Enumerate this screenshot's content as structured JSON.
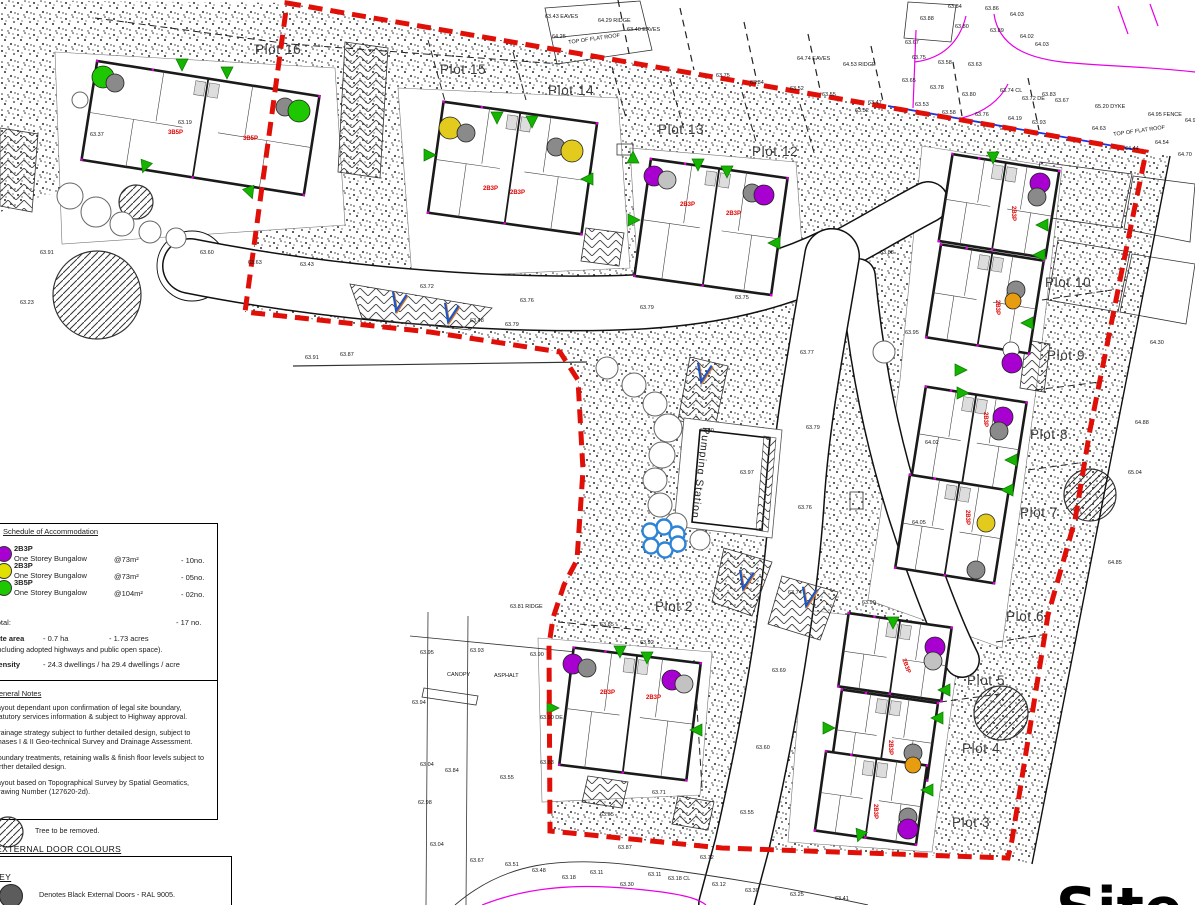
{
  "title_partial": "Site plan",
  "pumping_station": "Pumping Station",
  "colors": {
    "boundary_red": "#e01008",
    "legal_blue": "#2233dd",
    "survey_magenta": "#e800e8",
    "marker_purple": "#a800d0",
    "marker_yellow": "#e2cb1d",
    "marker_orange": "#e89c10",
    "marker_green": "#1ec800",
    "marker_gray": "#8a8a8a",
    "marker_lgray": "#c2c2c2",
    "marker_white": "#ffffff",
    "attenuation_blue": "#2d83d5",
    "unit_label_red": "#e00000"
  },
  "legend": {
    "schedule": {
      "heading": "Schedule of Accommodation",
      "items": [
        {
          "color": "#a800d0",
          "code": "2B3P",
          "desc": "One Storey Bungalow",
          "area": "@73m²",
          "count": "- 10no."
        },
        {
          "color": "#e2e000",
          "code": "2B3P",
          "desc": "One Storey Bungalow",
          "area": "@73m²",
          "count": "- 05no."
        },
        {
          "color": "#1ec800",
          "code": "3B5P",
          "desc": "One Storey Bungalow",
          "area": "@104m²",
          "count": "- 02no."
        }
      ],
      "total_label": "Total:",
      "total_value": "- 17 no.",
      "site_area_label": "Site area",
      "site_area_ha": "- 0.7 ha",
      "site_area_acres": "- 1.73 acres",
      "site_area_note": "(Including adopted highways and public open space).",
      "density_label": "Density",
      "density_ha": "- 24.3 dwellings / ha",
      "density_acre": "- 29.4 dwellings / acre"
    },
    "general_notes": {
      "heading": "General Notes",
      "notes": [
        "Layout dependant upon confirmation of legal site boundary, statutory services information & subject to Highway approval.",
        "Drainage strategy subject to further detailed design, subject to Phases I & II Geo-technical Survey and Drainage Assessment.",
        "Boundary treatments, retaining walls & finish floor levels subject to further detailed design.",
        "Layout based on Topographical Survey by Spatial Geomatics, Drawing Number (127620-2d)."
      ]
    },
    "tree_key": "Tree to be removed.",
    "door_colours_heading": "EXTERNAL DOOR COLOURS",
    "key_heading": "KEY",
    "key_item": "Denotes Black External Doors - RAL 9005."
  },
  "plots": [
    [
      255,
      42,
      "Plot 16"
    ],
    [
      440,
      62,
      "Plot 15"
    ],
    [
      548,
      83,
      "Plot 14"
    ],
    [
      658,
      122,
      "Plot 13"
    ],
    [
      752,
      144,
      "Plot 12"
    ],
    [
      1045,
      275,
      "Plot 10"
    ],
    [
      1047,
      348,
      "Plot 9"
    ],
    [
      1030,
      427,
      "Plot 8"
    ],
    [
      1020,
      505,
      "Plot 7"
    ],
    [
      1006,
      609,
      "Plot 6"
    ],
    [
      967,
      673,
      "Plot 5"
    ],
    [
      962,
      741,
      "Plot 4"
    ],
    [
      952,
      815,
      "Plot 3"
    ],
    [
      655,
      599,
      "Plot 2"
    ]
  ],
  "buildings": [
    [
      88,
      78,
      225,
      100,
      9
    ],
    [
      435,
      112,
      155,
      112,
      8
    ],
    [
      642,
      168,
      138,
      118,
      8
    ],
    [
      945,
      162,
      108,
      88,
      9
    ],
    [
      933,
      252,
      104,
      94,
      9
    ],
    [
      918,
      394,
      102,
      92,
      9
    ],
    [
      902,
      482,
      100,
      94,
      9
    ],
    [
      566,
      655,
      128,
      118,
      7
    ],
    [
      843,
      620,
      104,
      74,
      8
    ],
    [
      836,
      696,
      97,
      78,
      8
    ],
    [
      820,
      758,
      102,
      80,
      8
    ]
  ],
  "markers": [
    [
      103,
      77,
      11,
      "green"
    ],
    [
      115,
      83,
      9,
      "gray"
    ],
    [
      285,
      107,
      9,
      "gray"
    ],
    [
      299,
      111,
      11,
      "green"
    ],
    [
      450,
      128,
      11,
      "yellow"
    ],
    [
      466,
      133,
      9,
      "gray"
    ],
    [
      556,
      147,
      9,
      "gray"
    ],
    [
      572,
      151,
      11,
      "yellow"
    ],
    [
      654,
      176,
      10,
      "purple"
    ],
    [
      667,
      180,
      9,
      "lgray"
    ],
    [
      752,
      193,
      9,
      "gray"
    ],
    [
      764,
      195,
      10,
      "purple"
    ],
    [
      1040,
      183,
      10,
      "purple"
    ],
    [
      1037,
      197,
      9,
      "gray"
    ],
    [
      1016,
      290,
      9,
      "gray"
    ],
    [
      1013,
      301,
      8,
      "orange"
    ],
    [
      1011,
      350,
      8,
      "white"
    ],
    [
      1012,
      363,
      10,
      "purple"
    ],
    [
      1003,
      417,
      10,
      "purple"
    ],
    [
      999,
      431,
      9,
      "gray"
    ],
    [
      986,
      523,
      9,
      "yellow"
    ],
    [
      976,
      570,
      9,
      "gray"
    ],
    [
      573,
      664,
      10,
      "purple"
    ],
    [
      587,
      668,
      9,
      "gray"
    ],
    [
      672,
      680,
      10,
      "purple"
    ],
    [
      684,
      684,
      9,
      "lgray"
    ],
    [
      935,
      647,
      10,
      "purple"
    ],
    [
      933,
      661,
      9,
      "lgray"
    ],
    [
      913,
      753,
      9,
      "gray"
    ],
    [
      913,
      765,
      8,
      "orange"
    ],
    [
      908,
      817,
      9,
      "gray"
    ],
    [
      908,
      829,
      10,
      "purple"
    ]
  ],
  "triangles": [
    [
      182,
      64,
      180
    ],
    [
      227,
      72,
      180
    ],
    [
      145,
      166,
      200
    ],
    [
      250,
      192,
      160
    ],
    [
      497,
      117,
      180
    ],
    [
      532,
      121,
      180
    ],
    [
      429,
      155,
      90
    ],
    [
      588,
      179,
      270
    ],
    [
      698,
      164,
      180
    ],
    [
      727,
      171,
      180
    ],
    [
      633,
      220,
      90
    ],
    [
      775,
      243,
      270
    ],
    [
      993,
      157,
      180
    ],
    [
      1043,
      225,
      270
    ],
    [
      1040,
      255,
      270
    ],
    [
      1028,
      323,
      270
    ],
    [
      960,
      370,
      90
    ],
    [
      962,
      393,
      90
    ],
    [
      1012,
      460,
      270
    ],
    [
      1008,
      490,
      270
    ],
    [
      620,
      651,
      180
    ],
    [
      647,
      657,
      180
    ],
    [
      552,
      708,
      90
    ],
    [
      697,
      730,
      270
    ],
    [
      893,
      622,
      180
    ],
    [
      945,
      690,
      270
    ],
    [
      938,
      718,
      270
    ],
    [
      828,
      728,
      90
    ],
    [
      928,
      790,
      270
    ],
    [
      860,
      835,
      200
    ],
    [
      633,
      158,
      0
    ]
  ],
  "trees_removed": [
    [
      97,
      295,
      44
    ],
    [
      136,
      202,
      17
    ],
    [
      1090,
      495,
      26
    ],
    [
      1001,
      713,
      27
    ]
  ],
  "trees_plain": [
    [
      80,
      100,
      8
    ],
    [
      70,
      196,
      13
    ],
    [
      96,
      212,
      15
    ],
    [
      122,
      224,
      12
    ],
    [
      150,
      232,
      11
    ],
    [
      176,
      238,
      10
    ],
    [
      607,
      368,
      11
    ],
    [
      634,
      385,
      12
    ],
    [
      655,
      404,
      12
    ],
    [
      668,
      428,
      14
    ],
    [
      662,
      455,
      13
    ],
    [
      655,
      480,
      12
    ],
    [
      660,
      505,
      12
    ],
    [
      676,
      524,
      11
    ],
    [
      700,
      540,
      10
    ],
    [
      884,
      352,
      11
    ]
  ],
  "v_marks": [
    [
      398,
      302
    ],
    [
      450,
      313
    ],
    [
      703,
      373
    ],
    [
      745,
      580
    ],
    [
      808,
      597
    ]
  ],
  "attenuation_circles": [
    [
      650,
      531
    ],
    [
      664,
      527
    ],
    [
      677,
      534
    ],
    [
      651,
      546
    ],
    [
      665,
      550
    ],
    [
      678,
      544
    ]
  ],
  "unit_labels": [
    [
      "3B5P",
      168,
      130,
      0
    ],
    [
      "3B5P",
      243,
      136,
      0
    ],
    [
      "2B3P",
      483,
      186,
      0
    ],
    [
      "2B3P",
      510,
      190,
      0
    ],
    [
      "2B3P",
      680,
      202,
      0
    ],
    [
      "2B3P",
      726,
      211,
      0
    ],
    [
      "2B3P",
      600,
      690,
      0
    ],
    [
      "2B3P",
      646,
      695,
      0
    ],
    [
      "2B3P",
      1016,
      206,
      90
    ],
    [
      "2B3P",
      1000,
      300,
      90
    ],
    [
      "2B3P",
      988,
      412,
      90
    ],
    [
      "2B3P",
      970,
      510,
      90
    ],
    [
      "2B3P",
      906,
      658,
      70
    ],
    [
      "2B3P",
      893,
      740,
      90
    ],
    [
      "2B3P",
      878,
      804,
      90
    ]
  ],
  "spot_levels": [
    [
      948,
      4,
      "63.84"
    ],
    [
      985,
      6,
      "63.86"
    ],
    [
      1010,
      12,
      "64.03"
    ],
    [
      920,
      16,
      "63.88"
    ],
    [
      955,
      24,
      "63.80"
    ],
    [
      990,
      28,
      "63.89"
    ],
    [
      1020,
      34,
      "64.02"
    ],
    [
      1035,
      42,
      "64.03"
    ],
    [
      905,
      40,
      "63.67"
    ],
    [
      912,
      55,
      "63.75"
    ],
    [
      938,
      60,
      "63.58"
    ],
    [
      968,
      62,
      "63.63"
    ],
    [
      902,
      78,
      "63.65"
    ],
    [
      930,
      85,
      "63.78"
    ],
    [
      962,
      92,
      "63.80"
    ],
    [
      1000,
      88,
      "63.74 CL"
    ],
    [
      1022,
      96,
      "63.72 DE"
    ],
    [
      1042,
      92,
      "63.83"
    ],
    [
      1055,
      98,
      "63.67"
    ],
    [
      915,
      102,
      "63.53"
    ],
    [
      942,
      110,
      "63.58"
    ],
    [
      975,
      112,
      "63.76"
    ],
    [
      1008,
      116,
      "64.19"
    ],
    [
      1032,
      120,
      "63.93"
    ],
    [
      545,
      14,
      "63.43 EAVES"
    ],
    [
      598,
      18,
      "64.29 RIDGE"
    ],
    [
      552,
      34,
      "64.25"
    ],
    [
      627,
      27,
      "63.40 EAVES"
    ],
    [
      797,
      56,
      "64.74 EAVES"
    ],
    [
      843,
      62,
      "64.53 RIDGE"
    ],
    [
      868,
      100,
      "63.47"
    ],
    [
      716,
      73,
      "63.75"
    ],
    [
      750,
      80,
      "63.84"
    ],
    [
      790,
      86,
      "63.52"
    ],
    [
      822,
      92,
      "63.55"
    ],
    [
      855,
      108,
      "63.52"
    ],
    [
      568,
      40,
      "TOP OF FLAT ROOF",
      -8
    ],
    [
      1113,
      132,
      "TOP OF FLAT ROOF",
      -8
    ],
    [
      1095,
      104,
      "65.20 DYKE"
    ],
    [
      1148,
      112,
      "64.95 FENCE"
    ],
    [
      1185,
      118,
      "64.99 DYKE"
    ],
    [
      1092,
      126,
      "64.63"
    ],
    [
      1125,
      146,
      "64.44"
    ],
    [
      1155,
      140,
      "64.54"
    ],
    [
      1178,
      152,
      "64.70"
    ],
    [
      305,
      355,
      "63.91"
    ],
    [
      340,
      352,
      "63.87"
    ],
    [
      510,
      604,
      "63.81 RIDGE"
    ],
    [
      447,
      672,
      "CANOPY"
    ],
    [
      494,
      673,
      "ASPHALT"
    ],
    [
      420,
      650,
      "63.95"
    ],
    [
      470,
      648,
      "63.93"
    ],
    [
      530,
      652,
      "63.90"
    ],
    [
      412,
      700,
      "63.94"
    ],
    [
      540,
      715,
      "63.90 DE"
    ],
    [
      420,
      762,
      "63.04"
    ],
    [
      445,
      768,
      "63.84"
    ],
    [
      500,
      775,
      "63.55"
    ],
    [
      540,
      760,
      "63.83"
    ],
    [
      418,
      800,
      "62.98"
    ],
    [
      430,
      842,
      "63.04"
    ],
    [
      470,
      858,
      "63.67"
    ],
    [
      505,
      862,
      "63.51"
    ],
    [
      532,
      868,
      "63.48"
    ],
    [
      562,
      875,
      "63.18"
    ],
    [
      590,
      870,
      "63.11"
    ],
    [
      620,
      882,
      "63.30"
    ],
    [
      648,
      872,
      "63.11"
    ],
    [
      668,
      876,
      "63.18 CL"
    ],
    [
      712,
      882,
      "63.12"
    ],
    [
      745,
      888,
      "63.30"
    ],
    [
      790,
      892,
      "63.25"
    ],
    [
      835,
      896,
      "63.41"
    ],
    [
      618,
      845,
      "63.87"
    ],
    [
      700,
      855,
      "63.72"
    ],
    [
      1150,
      340,
      "64.30"
    ],
    [
      1135,
      420,
      "64.88"
    ],
    [
      1128,
      470,
      "65.04"
    ],
    [
      1108,
      560,
      "64.85"
    ],
    [
      300,
      262,
      "63.43"
    ],
    [
      420,
      284,
      "63.72"
    ],
    [
      520,
      298,
      "63.76"
    ],
    [
      640,
      305,
      "63.79"
    ],
    [
      735,
      295,
      "63.75"
    ],
    [
      800,
      350,
      "63.77"
    ],
    [
      806,
      425,
      "63.79"
    ],
    [
      798,
      505,
      "63.76"
    ],
    [
      470,
      318,
      "63.48"
    ],
    [
      505,
      322,
      "63.79"
    ],
    [
      740,
      470,
      "63.97"
    ],
    [
      700,
      428,
      "63.80"
    ],
    [
      788,
      590,
      "63.74"
    ],
    [
      772,
      668,
      "63.69"
    ],
    [
      756,
      745,
      "63.60"
    ],
    [
      740,
      810,
      "63.55"
    ],
    [
      652,
      790,
      "63.71"
    ],
    [
      600,
      812,
      "63.65"
    ],
    [
      880,
      250,
      "63.88"
    ],
    [
      905,
      330,
      "63.95"
    ],
    [
      925,
      440,
      "64.02"
    ],
    [
      912,
      520,
      "64.05"
    ],
    [
      862,
      600,
      "63.90"
    ],
    [
      640,
      640,
      "63.92"
    ],
    [
      600,
      622,
      "63.85"
    ],
    [
      90,
      132,
      "63.37"
    ],
    [
      178,
      120,
      "63.19"
    ],
    [
      248,
      260,
      "63.63"
    ],
    [
      200,
      250,
      "63.60"
    ],
    [
      40,
      250,
      "63.91"
    ],
    [
      20,
      300,
      "63.23"
    ]
  ]
}
